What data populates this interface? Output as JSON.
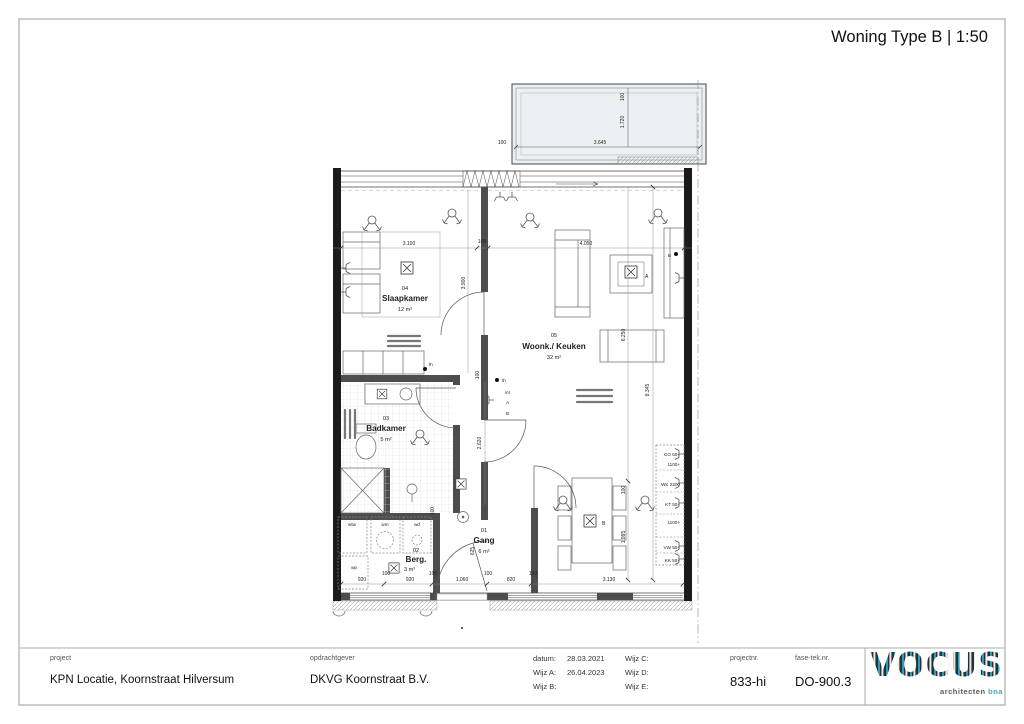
{
  "title": "Woning Type B | 1:50",
  "rooms": {
    "gang": {
      "number": "01",
      "name": "Gang",
      "area": "6 m²"
    },
    "berg": {
      "number": "02",
      "name": "Berg.",
      "area": "3 m²"
    },
    "badkamer": {
      "number": "03",
      "name": "Badkamer",
      "area": "5 m²"
    },
    "slaapkamer": {
      "number": "04",
      "name": "Slaapkamer",
      "area": "12 m²"
    },
    "woonkamer": {
      "number": "05",
      "name": "Woonk./ Keuken",
      "area": "32 m²"
    }
  },
  "dims": {
    "balcony_w": "3.645",
    "balcony_d": "1.720",
    "balcony_o1": "100",
    "balcony_o2": "100",
    "top_1": "3.100",
    "top_2": "100",
    "top_3": "4.050",
    "v_slaapkamer": "3.900",
    "v_woonkamer": "6.250",
    "v_total": "8.345",
    "v_gang": "2.620",
    "v_wall": "100",
    "v_gang2": "625",
    "v_gang3": "100",
    "v_table": "1.995",
    "v_t100": "100",
    "bottom": [
      "920",
      "100",
      "920",
      "100",
      "1.060",
      "100",
      "820",
      "100",
      "3.130"
    ]
  },
  "kitchen_notes": [
    "CO 50+",
    "1100+",
    "WK 2200",
    "KT 50+",
    "1100+",
    "VW 50+",
    "KK 50+"
  ],
  "appliances": {
    "wtw": "wtw",
    "wm": "wm",
    "wd": "wd",
    "wp": "wp"
  },
  "electrical": {
    "th": "th",
    "int": "int",
    "a": "A",
    "b": "B"
  },
  "lights": {
    "a": "A",
    "b": "B"
  },
  "titleblock": {
    "project_label": "project",
    "project": "KPN Locatie, Koornstraat Hilversum",
    "client_label": "opdrachtgever",
    "client": "DKVG Koornstraat B.V.",
    "datum_label": "datum:",
    "datum": "28.03.2021",
    "wijz_a_label": "Wijz A:",
    "wijz_a": "26.04.2023",
    "wijz_b_label": "Wijz B:",
    "wijz_c_label": "Wijz C:",
    "wijz_d_label": "Wijz D:",
    "wijz_e_label": "Wijz E:",
    "projectnr_label": "projectnr.",
    "projectnr": "833-hi",
    "fase_label": "fase-tek.nr.",
    "fase": "DO-900.3",
    "logo": "VOCUS",
    "logo_sub": "architecten",
    "logo_sub2": "bna"
  }
}
